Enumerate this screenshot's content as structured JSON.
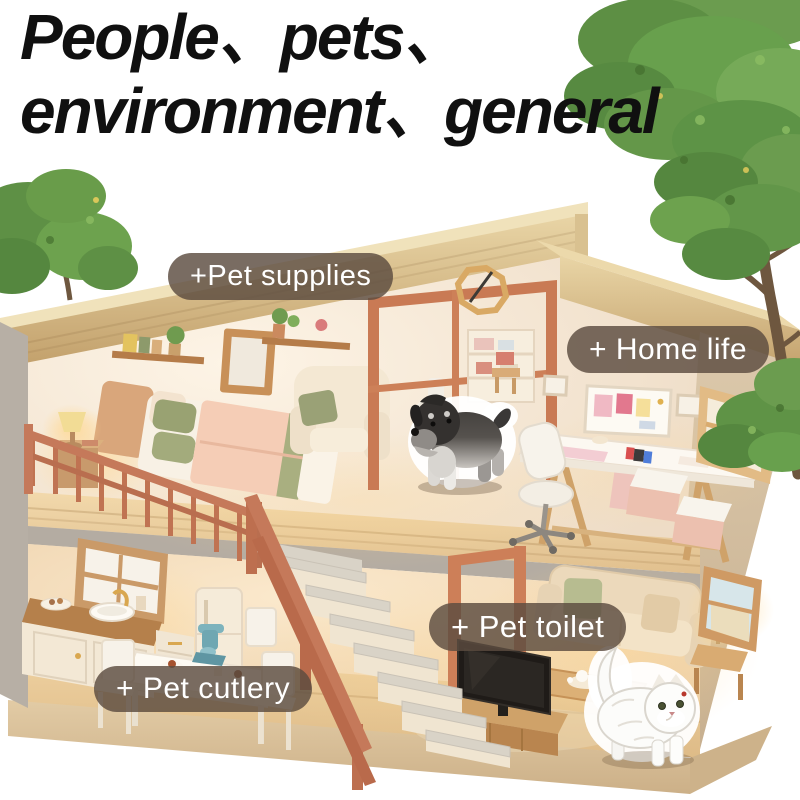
{
  "title": {
    "line1": "People、pets、",
    "line2": "environment、general"
  },
  "hotspots": [
    {
      "id": "pet-supplies",
      "label": "+Pet supplies"
    },
    {
      "id": "home-life",
      "label": "+ Home life"
    },
    {
      "id": "pet-toilet",
      "label": "+ Pet toilet"
    },
    {
      "id": "pet-cutlery",
      "label": "+ Pet cutlery"
    }
  ],
  "scene": {
    "stickers": {
      "dog": "schnauzer-puppy-sticker",
      "cat": "persian-cat-sticker"
    }
  },
  "palette": {
    "title_color": "#101010",
    "label_bg": "rgba(92,76,63,0.82)",
    "label_text": "#ffffff",
    "roof_wood": "#cdb07c",
    "wall_cream": "#f5e8d7",
    "floor_wood": "#e9cfa2",
    "terracotta": "#c37a58",
    "slab_grey": "#b5ada3",
    "base_tan": "#d8c09b",
    "tree_green": "#5f8f45",
    "sofa_beige": "#e9d6b8",
    "tv_black": "#211d1a"
  }
}
